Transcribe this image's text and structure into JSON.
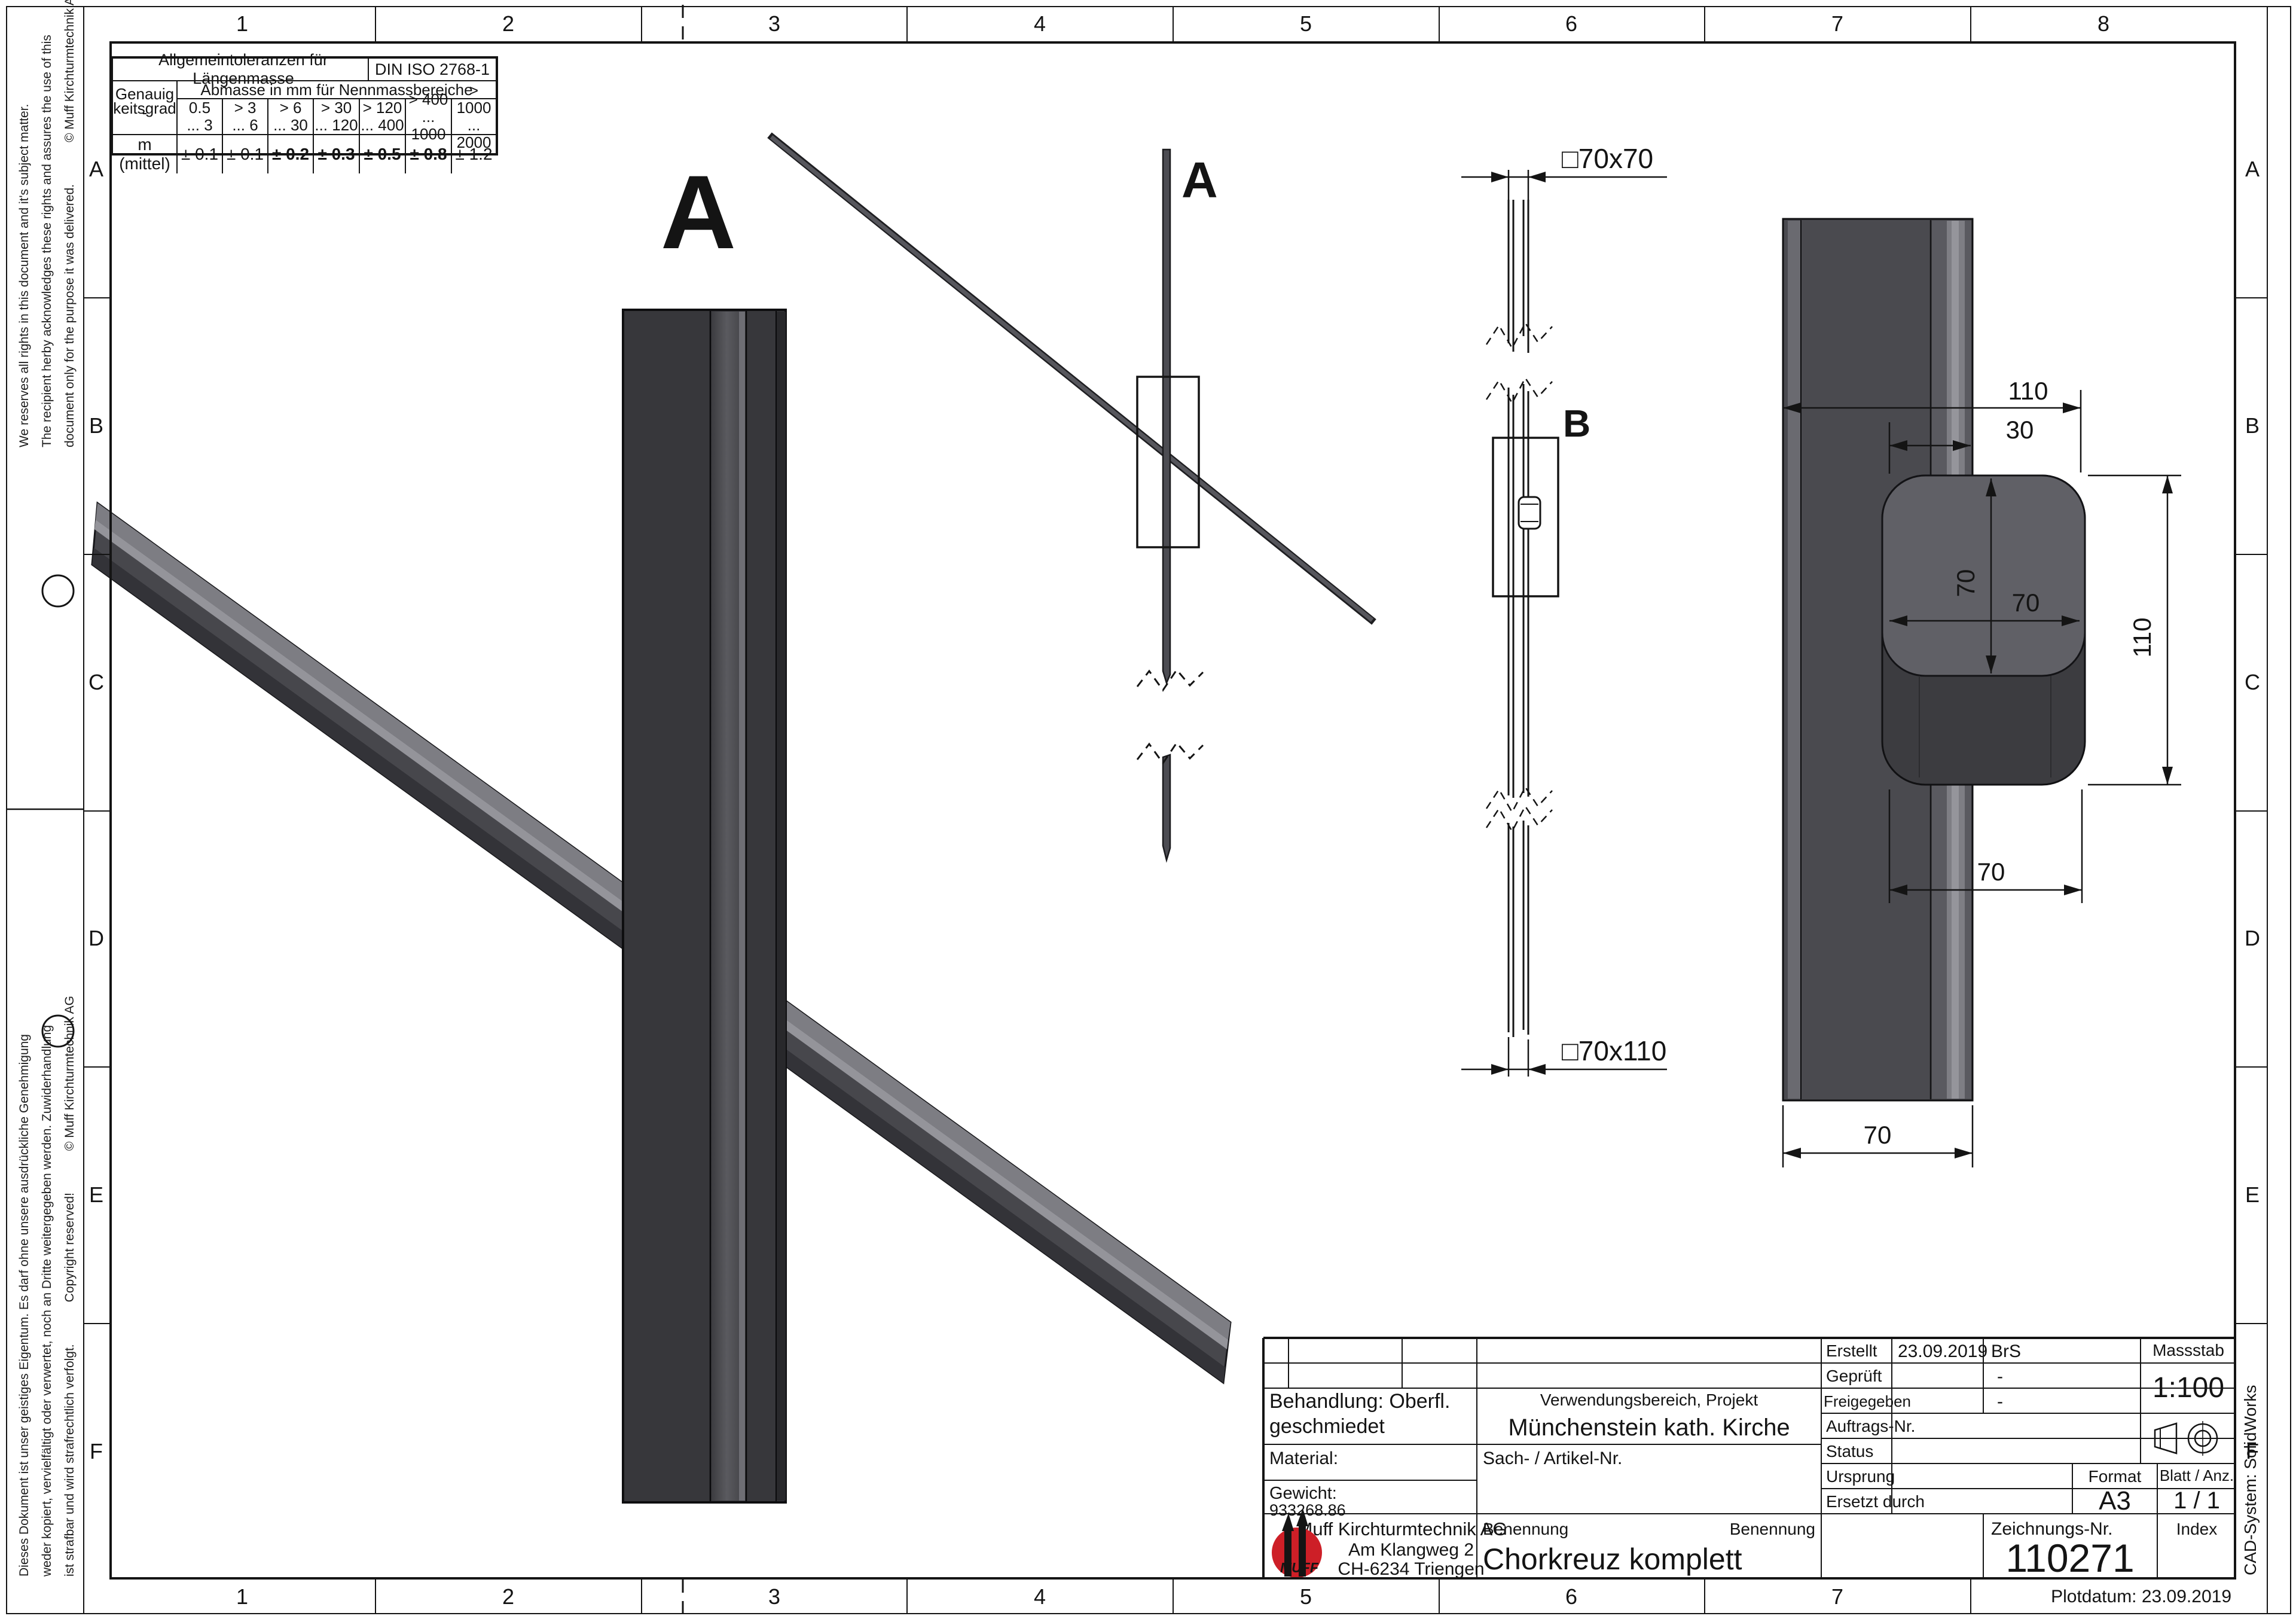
{
  "sheet": {
    "zone_numbers": [
      "1",
      "2",
      "3",
      "4",
      "5",
      "6",
      "7",
      "8"
    ],
    "zone_letters": [
      "A",
      "B",
      "C",
      "D",
      "E",
      "F"
    ],
    "plotdatum": "Plotdatum: 23.09.2019",
    "cad_system": "CAD-System: SolidWorks",
    "note_en_line1": "We reserves all rights in this document and it's subject matter.",
    "note_en_line2": "The recipient herby acknowledges these rights and assures the use of this",
    "note_en_line3": "document only for the purpose it was delivered.",
    "note_en_copyright": "© Muff Kirchturmtechnik AG",
    "note_de_line1": "Dieses Dokument ist unser geistiges Eigentum. Es darf ohne unsere ausdrückliche Genehmigung",
    "note_de_line2": "weder kopiert, vervielfältigt oder verwertet, noch an Dritte weitergegeben werden. Zuwiderhandlung",
    "note_de_line3": "ist strafbar und wird strafrechtlich verfolgt.",
    "note_de_copyright1": "Copyright reserved!",
    "note_de_copyright2": "© Muff Kirchturmtechnik AG"
  },
  "tolerance_table": {
    "title": "Allgemeintoleranzen für Längenmasse",
    "standard": "DIN  ISO 2768-1",
    "grade_line1": "Genauig -",
    "grade_line2": "keitsgrad",
    "header": "Abmasse in mm für Nennmassbereiche",
    "ranges": [
      [
        "0.5",
        "... 3"
      ],
      [
        "> 3",
        "... 6"
      ],
      [
        "> 6",
        "... 30"
      ],
      [
        "> 30",
        "... 120"
      ],
      [
        "> 120",
        "... 400"
      ],
      [
        "> 400",
        "... 1000"
      ],
      [
        "> 1000",
        "... 2000"
      ]
    ],
    "row_label": "m  (mittel)",
    "values": [
      "± 0.1",
      "± 0.1",
      "± 0.2",
      "± 0.3",
      "± 0.5",
      "± 0.8",
      "± 1.2"
    ]
  },
  "views": {
    "detail_a_label": "A",
    "view_a_label": "A",
    "detail_b_label": "B",
    "dims": {
      "sq7070": "□70x70",
      "sq70110": "□70x110",
      "d110_top": "110",
      "d30": "30",
      "d70_boss_w": "70",
      "d70_boss_h": "70",
      "d110_right": "110",
      "d70_under": "70",
      "d70_bar": "70"
    }
  },
  "title_block": {
    "behandlung_line1": "Behandlung: Oberfl.",
    "behandlung_line2": "geschmiedet",
    "verwendung_label": "Verwendungsbereich, Projekt",
    "verwendung_value": "Münchenstein kath. Kirche",
    "material_label": "Material:",
    "sach_label": "Sach- / Artikel-Nr.",
    "gewicht_label": "Gewicht:",
    "gewicht_value": "933268.86",
    "company_name": "Muff Kirchturmtechnik AG",
    "company_street": "Am Klangweg 2",
    "company_city": "CH-6234 Triengen",
    "logo_text": "MUFF",
    "benennung_label": "Benennung",
    "benennung_value": "Chorkreuz komplett",
    "erstellt_label": "Erstellt",
    "erstellt_date": "23.09.2019",
    "erstellt_by": "BrS",
    "geprueft_label": "Geprüft",
    "geprueft_value": "-",
    "freigegeben_label": "Freigegeben",
    "freigegeben_value": "-",
    "auftrag_label": "Auftrags-Nr.",
    "status_label": "Status",
    "ursprung_label": "Ursprung",
    "ersetzt_label": "Ersetzt durch",
    "massstab_label": "Massstab",
    "massstab_value": "1:100",
    "format_label": "Format",
    "format_value": "A3",
    "blatt_label": "Blatt / Anz.",
    "blatt_value": "1 / 1",
    "zeichnung_label": "Zeichnungs-Nr.",
    "zeichnung_value": "110271",
    "index_label": "Index"
  }
}
